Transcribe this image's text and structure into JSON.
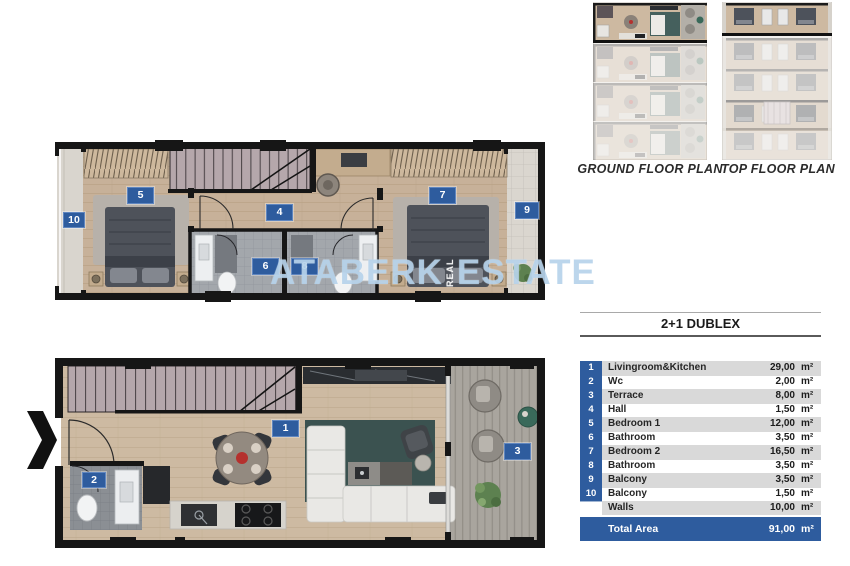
{
  "colors": {
    "accent_blue": "#2e5c9e",
    "table_row_gray": "#d9d9d9",
    "wall_black": "#161616",
    "wood_floor": "#c8b29a",
    "stairs_mauve": "#b5a7ab",
    "teal_rug": "#3b5250",
    "deck_gray": "#a9a59e",
    "watermark_blue": "#adcde8"
  },
  "thumbnails": {
    "ground": {
      "label": "GROUND FLOOR PLAN"
    },
    "top": {
      "label": "TOP FLOOR PLAN"
    }
  },
  "watermark": {
    "brand_left": "ATABERK",
    "brand_right": "ESTATE",
    "vertical": "REAL"
  },
  "plans": {
    "top_floor": {
      "badges": {
        "bedroom1": "5",
        "hall": "4",
        "bathroom1": "6",
        "bathroom2": "8",
        "bedroom2": "7",
        "balcony9": "9",
        "balcony10": "10"
      }
    },
    "ground_floor": {
      "badges": {
        "livingroom": "1",
        "wc": "2",
        "terrace": "3"
      }
    }
  },
  "table": {
    "title": "2+1 DUBLEX",
    "unit": "m²",
    "rows": [
      {
        "num": "1",
        "label": "Livingroom&Kitchen",
        "value": "29,00"
      },
      {
        "num": "2",
        "label": "Wc",
        "value": "2,00"
      },
      {
        "num": "3",
        "label": "Terrace",
        "value": "8,00"
      },
      {
        "num": "4",
        "label": "Hall",
        "value": "1,50"
      },
      {
        "num": "5",
        "label": "Bedroom 1",
        "value": "12,00"
      },
      {
        "num": "6",
        "label": "Bathroom",
        "value": "3,50"
      },
      {
        "num": "7",
        "label": "Bedroom 2",
        "value": "16,50"
      },
      {
        "num": "8",
        "label": "Bathroom",
        "value": "3,50"
      },
      {
        "num": "9",
        "label": "Balcony",
        "value": "3,50"
      },
      {
        "num": "10",
        "label": "Balcony",
        "value": "1,50"
      },
      {
        "num": "",
        "label": "Walls",
        "value": "10,00"
      }
    ],
    "total": {
      "label": "Total Area",
      "value": "91,00"
    }
  }
}
